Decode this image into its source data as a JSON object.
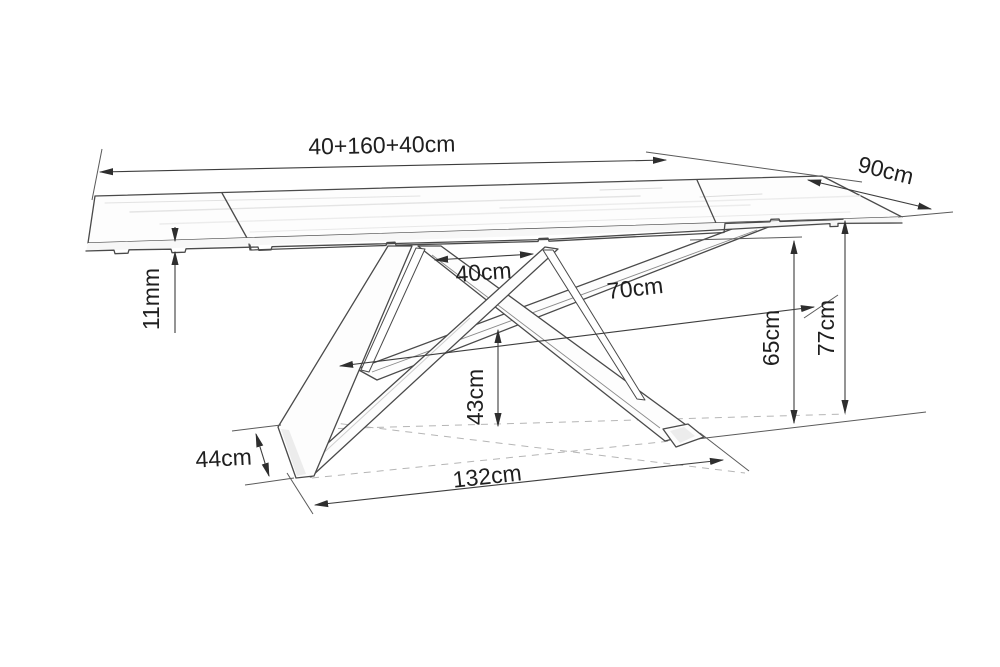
{
  "diagram": {
    "type": "technical-drawing",
    "subject": "extendable dining table with X-shaped metal base, dimensioned line drawing",
    "background_color": "#ffffff",
    "line_color": "#4a4a4a",
    "text_color": "#1f1f1f",
    "dashed_line_color": "#b5b5b5",
    "dimensions": {
      "top_length": {
        "label": "40+160+40cm",
        "value": "40+160+40",
        "unit": "cm"
      },
      "depth": {
        "label": "90cm",
        "value": 90,
        "unit": "cm"
      },
      "top_thickness": {
        "label": "11mm",
        "value": 11,
        "unit": "mm"
      },
      "plate_width": {
        "label": "40cm",
        "value": 40,
        "unit": "cm"
      },
      "base_top_span": {
        "label": "70cm",
        "value": 70,
        "unit": "cm"
      },
      "cross_height": {
        "label": "43cm",
        "value": 43,
        "unit": "cm"
      },
      "clearance_height": {
        "label": "65cm",
        "value": 65,
        "unit": "cm"
      },
      "table_height": {
        "label": "77cm",
        "value": 77,
        "unit": "cm"
      },
      "foot_width": {
        "label": "44cm",
        "value": 44,
        "unit": "cm"
      },
      "base_length": {
        "label": "132cm",
        "value": 132,
        "unit": "cm"
      }
    }
  }
}
